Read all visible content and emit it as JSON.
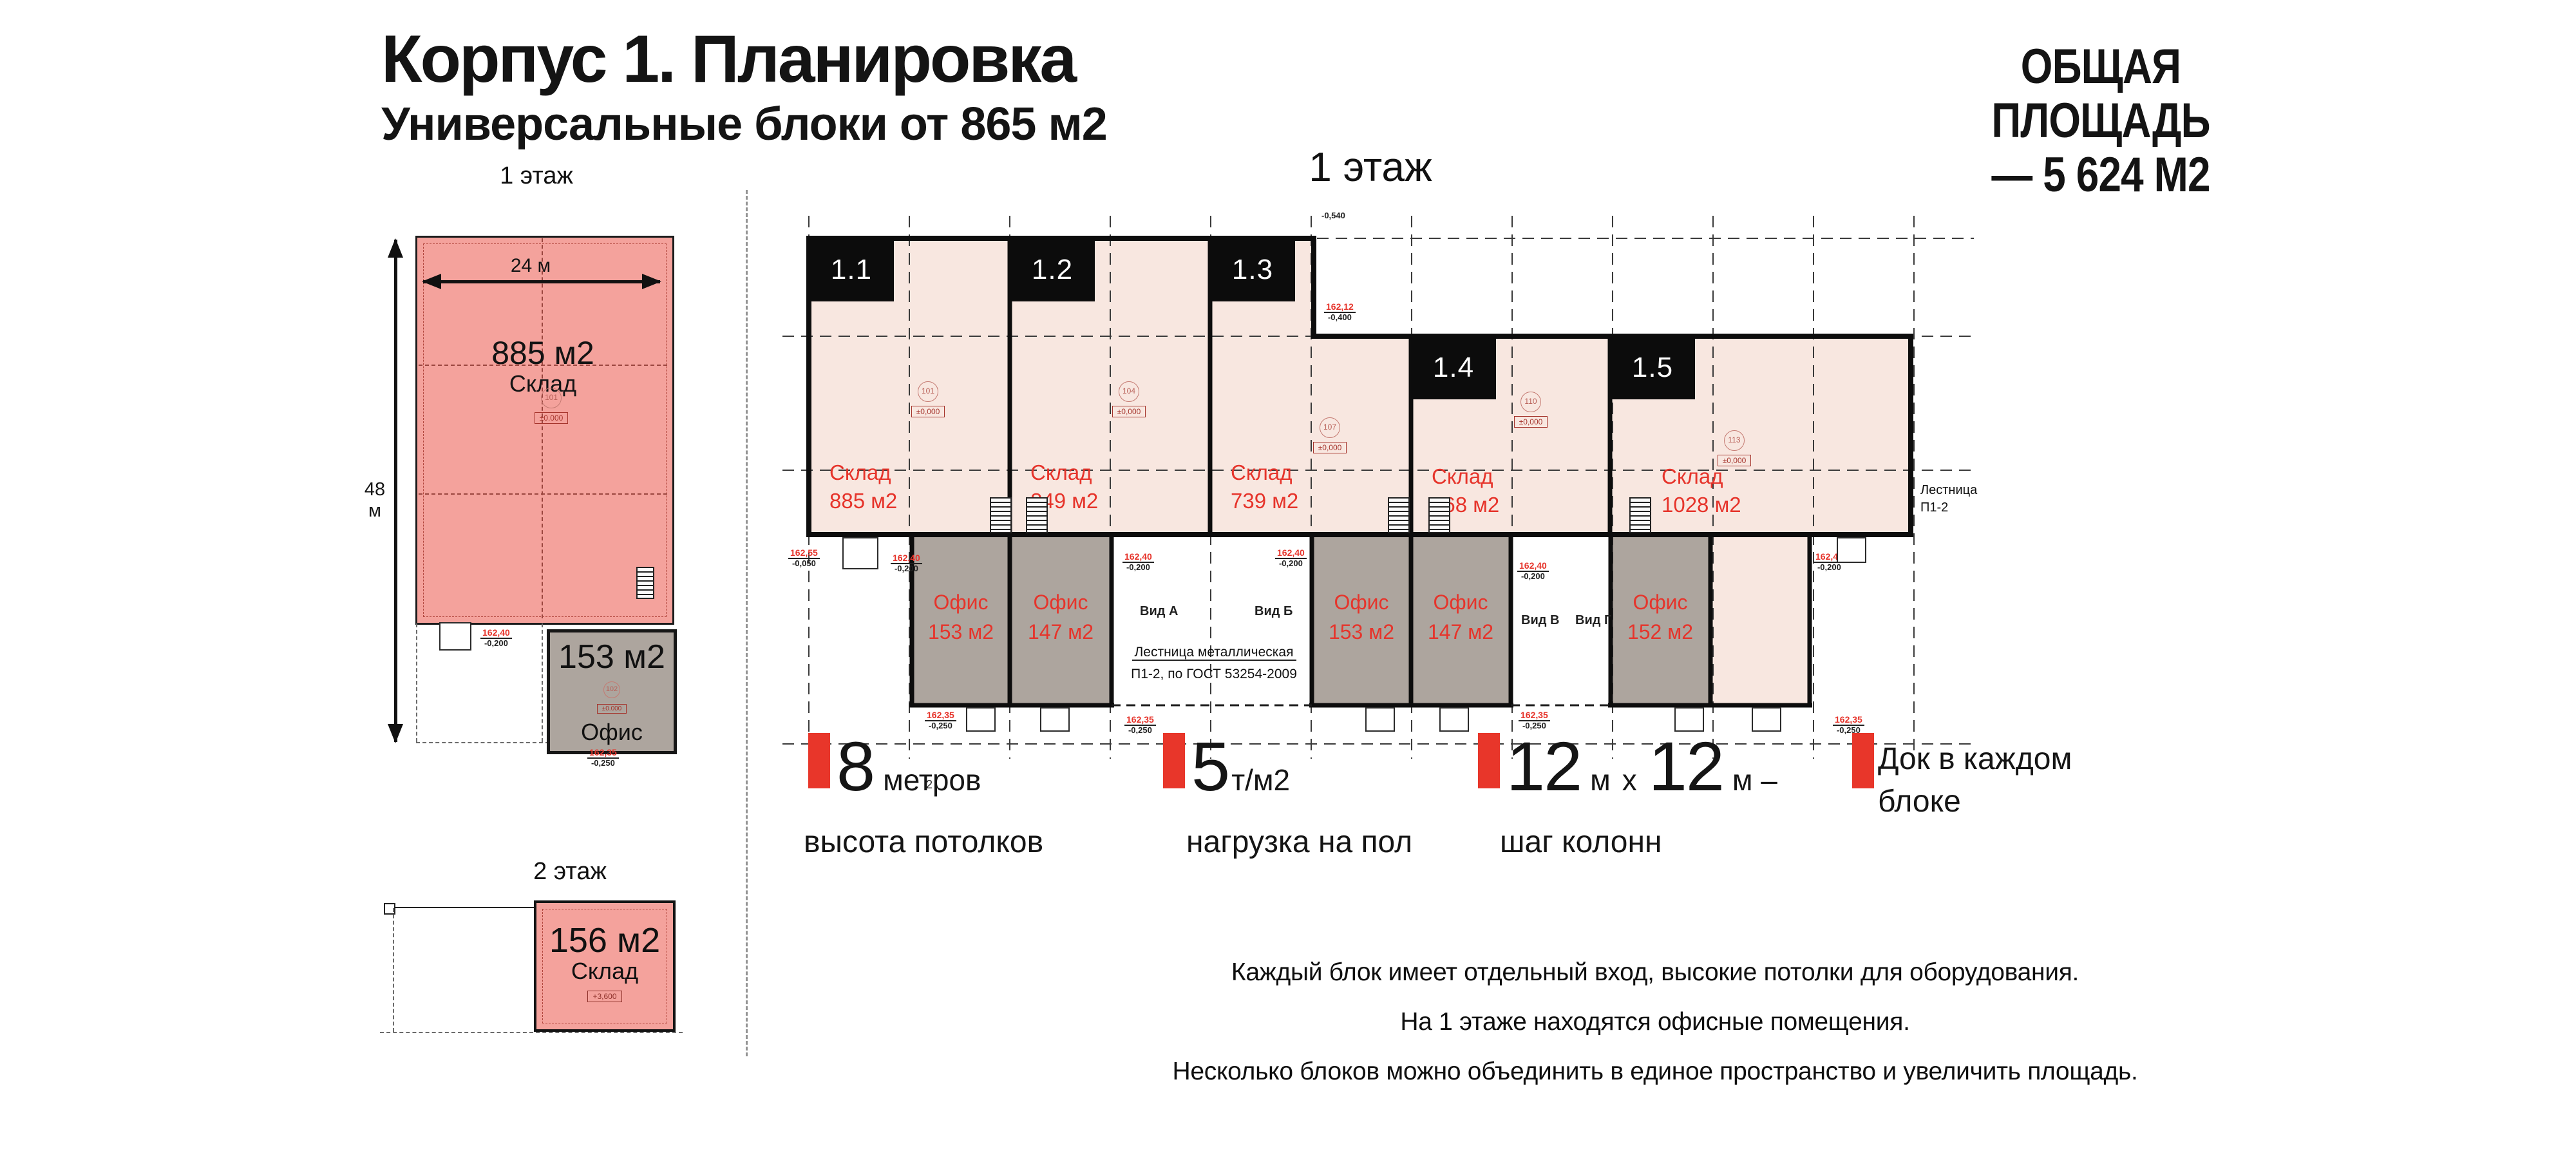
{
  "header": {
    "title": "Корпус 1. Планировка",
    "subtitle": "Универсальные блоки от 865 м2",
    "total_area_line1": "ОБЩАЯ ПЛОЩАДЬ",
    "total_area_line2": "— 5 624 М2"
  },
  "left_floor1": {
    "label": "1 этаж",
    "dim_width": "24 м",
    "dim_height": "48 м",
    "area": "885 м2",
    "room_type": "Склад",
    "room_number": "101",
    "level_mark": "±0.000",
    "office": {
      "area": "153 м2",
      "room_type": "Офис",
      "room_number": "102",
      "level_mark": "±0.000"
    },
    "elev_top": "162,40",
    "elev_bottom": "-0,200",
    "elev2_top": "162,35",
    "elev2_bottom": "-0,250"
  },
  "left_floor2": {
    "label": "2 этаж",
    "area": "156 м2",
    "room_type": "Склад",
    "level_mark": "+3,600"
  },
  "main_plan": {
    "title": "1 этаж",
    "level_mark": "±0,000",
    "blocks": [
      {
        "id": "1.1",
        "room_type": "Склад",
        "area": "885 м2",
        "room_number": "101"
      },
      {
        "id": "1.2",
        "room_type": "Склад",
        "area": "849 м2",
        "room_number": "104"
      },
      {
        "id": "1.3",
        "room_type": "Склад",
        "area": "739 м2",
        "room_number": "107"
      },
      {
        "id": "1.4",
        "room_type": "Склад",
        "area": "568 м2",
        "room_number": "110"
      },
      {
        "id": "1.5",
        "room_type": "Склад",
        "area": "1028 м2",
        "room_number": "113"
      }
    ],
    "offices": [
      {
        "room_type": "Офис",
        "area": "153 м2"
      },
      {
        "room_type": "Офис",
        "area": "147 м2"
      },
      {
        "room_type": "Офис",
        "area": "153 м2"
      },
      {
        "room_type": "Офис",
        "area": "147 м2"
      },
      {
        "room_type": "Офис",
        "area": "152 м2"
      }
    ],
    "views": [
      "Вид А",
      "Вид Б",
      "Вид В",
      "Вид Г"
    ],
    "stair_note_line1": "Лестница металлическая",
    "stair_note_line2": "П1-2, по ГОСТ 53254-2009",
    "side_note_line1": "Лестница",
    "side_note_line2": "П1-2",
    "axis_label": "2",
    "elevations": {
      "e050": {
        "top": "162,55",
        "bottom": "-0,050"
      },
      "e200": {
        "top": "162,40",
        "bottom": "-0,200"
      },
      "e250": {
        "top": "162,35",
        "bottom": "-0,250"
      },
      "e400": {
        "top": "162,12",
        "bottom": "-0,400"
      },
      "e540": {
        "top": "",
        "bottom": "-0,540"
      }
    }
  },
  "features": [
    {
      "num": "8",
      "unit": "метров",
      "caption": "высота потолков"
    },
    {
      "num": "5",
      "unit": "т/м2",
      "caption": "нагрузка на пол"
    },
    {
      "num": "12",
      "unit": "м",
      "mid": "х",
      "num2": "12",
      "unit2": "м –",
      "caption": "шаг колонн"
    },
    {
      "line1": "Док в каждом",
      "line2": "блоке"
    }
  ],
  "footer_lines": [
    "Каждый блок имеет отдельный вход, высокие потолки для оборудования.",
    "На 1 этаже находятся офисные помещения.",
    "Несколько блоков можно объединить в единое пространство и увеличить площадь."
  ],
  "colors": {
    "accent_red": "#e8362a",
    "plan_pink_strong": "#f4a29c",
    "plan_pink_light": "#f8e7e0",
    "office_gray": "#ada59e",
    "line_black": "#0d0d0d"
  }
}
